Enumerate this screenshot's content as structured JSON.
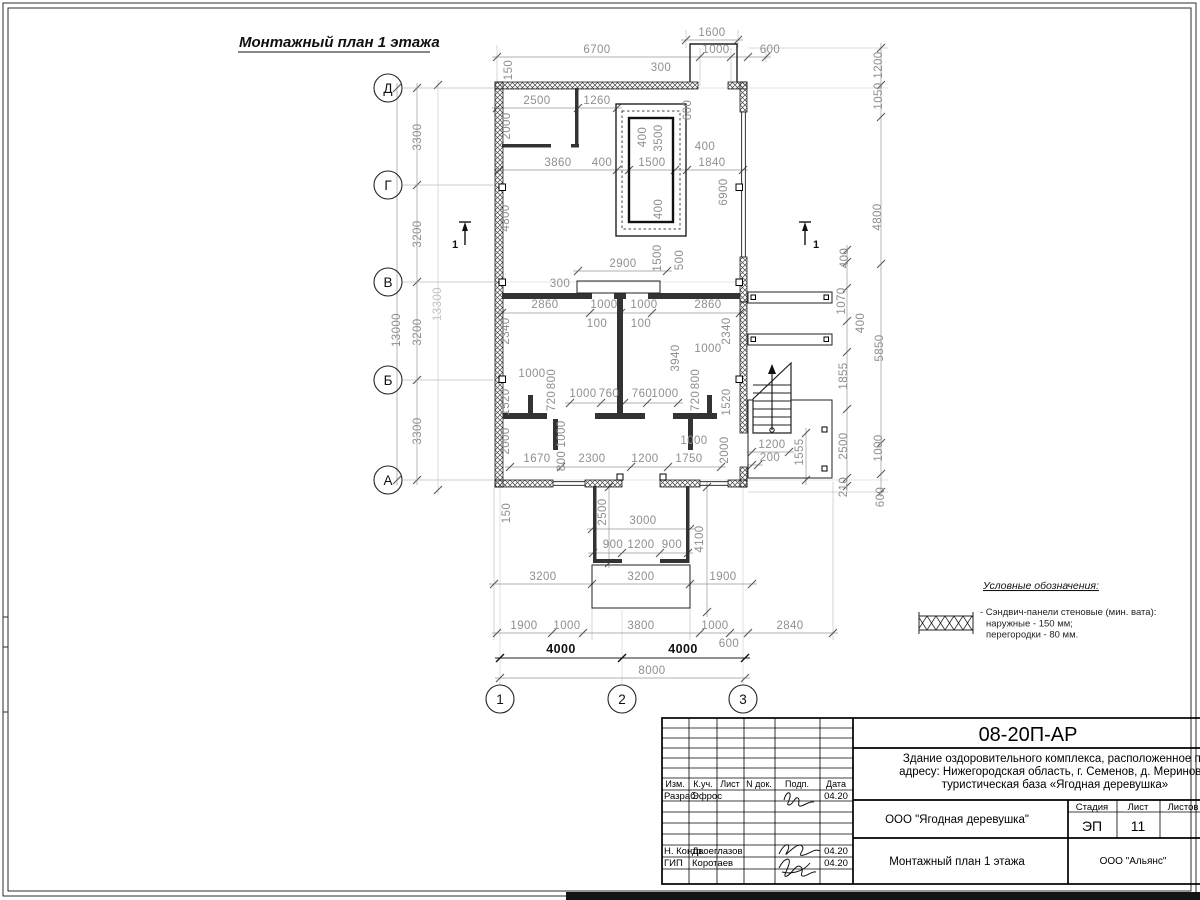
{
  "drawing_title": "Монтажный план 1 этажа",
  "plan": {
    "axes": {
      "rows": [
        "Д",
        "Г",
        "В",
        "Б",
        "А"
      ],
      "cols": [
        "1",
        "2",
        "3"
      ]
    },
    "section_label": "1",
    "dimensions": [
      {
        "t": "1600",
        "x": 712,
        "y": 36
      },
      {
        "t": "6700",
        "x": 597,
        "y": 53
      },
      {
        "t": "1000",
        "x": 716,
        "y": 53
      },
      {
        "t": "600",
        "x": 770,
        "y": 53
      },
      {
        "t": "300",
        "x": 661,
        "y": 71
      },
      {
        "t": "2500",
        "x": 537,
        "y": 104
      },
      {
        "t": "1260",
        "x": 597,
        "y": 104
      },
      {
        "t": "150",
        "x": 512,
        "y": 70,
        "r": 1
      },
      {
        "t": "2000",
        "x": 510,
        "y": 126,
        "r": 1
      },
      {
        "t": "600",
        "x": 691,
        "y": 110,
        "r": 1
      },
      {
        "t": "400",
        "x": 646,
        "y": 137,
        "r": 1
      },
      {
        "t": "3500",
        "x": 662,
        "y": 138,
        "r": 1
      },
      {
        "t": "400",
        "x": 705,
        "y": 150
      },
      {
        "t": "3860",
        "x": 558,
        "y": 166
      },
      {
        "t": "400",
        "x": 602,
        "y": 166
      },
      {
        "t": "1500",
        "x": 652,
        "y": 166
      },
      {
        "t": "1840",
        "x": 712,
        "y": 166
      },
      {
        "t": "6900",
        "x": 727,
        "y": 192,
        "r": 1
      },
      {
        "t": "4800",
        "x": 509,
        "y": 218,
        "r": 1
      },
      {
        "t": "400",
        "x": 662,
        "y": 209,
        "r": 1
      },
      {
        "t": "2900",
        "x": 623,
        "y": 267
      },
      {
        "t": "1500",
        "x": 661,
        "y": 258,
        "r": 1
      },
      {
        "t": "500",
        "x": 683,
        "y": 260,
        "r": 1
      },
      {
        "t": "300",
        "x": 560,
        "y": 287
      },
      {
        "t": "2860",
        "x": 545,
        "y": 308
      },
      {
        "t": "1000",
        "x": 604,
        "y": 308
      },
      {
        "t": "1000",
        "x": 644,
        "y": 308
      },
      {
        "t": "2860",
        "x": 708,
        "y": 308
      },
      {
        "t": "100",
        "x": 597,
        "y": 327
      },
      {
        "t": "100",
        "x": 641,
        "y": 327
      },
      {
        "t": "2340",
        "x": 509,
        "y": 331,
        "r": 1
      },
      {
        "t": "2340",
        "x": 730,
        "y": 331,
        "r": 1
      },
      {
        "t": "3940",
        "x": 679,
        "y": 358,
        "r": 1
      },
      {
        "t": "1000",
        "x": 708,
        "y": 352
      },
      {
        "t": "1000",
        "x": 532,
        "y": 377
      },
      {
        "t": "800",
        "x": 555,
        "y": 379,
        "r": 1
      },
      {
        "t": "720",
        "x": 555,
        "y": 401,
        "r": 1
      },
      {
        "t": "800",
        "x": 699,
        "y": 379,
        "r": 1
      },
      {
        "t": "720",
        "x": 699,
        "y": 401,
        "r": 1
      },
      {
        "t": "1520",
        "x": 509,
        "y": 402,
        "r": 1
      },
      {
        "t": "1520",
        "x": 730,
        "y": 402,
        "r": 1
      },
      {
        "t": "1000",
        "x": 583,
        "y": 397
      },
      {
        "t": "760",
        "x": 609,
        "y": 397
      },
      {
        "t": "760",
        "x": 642,
        "y": 397
      },
      {
        "t": "1000",
        "x": 665,
        "y": 397
      },
      {
        "t": "2000",
        "x": 509,
        "y": 441,
        "r": 1
      },
      {
        "t": "1000",
        "x": 565,
        "y": 434,
        "r": 1
      },
      {
        "t": "800",
        "x": 565,
        "y": 461,
        "r": 1
      },
      {
        "t": "1670",
        "x": 537,
        "y": 462
      },
      {
        "t": "2300",
        "x": 592,
        "y": 462
      },
      {
        "t": "1200",
        "x": 645,
        "y": 462
      },
      {
        "t": "1750",
        "x": 689,
        "y": 462
      },
      {
        "t": "1000",
        "x": 694,
        "y": 444
      },
      {
        "t": "2000",
        "x": 728,
        "y": 450,
        "r": 1
      },
      {
        "t": "1200",
        "x": 772,
        "y": 448
      },
      {
        "t": "200",
        "x": 770,
        "y": 461
      },
      {
        "t": "1555",
        "x": 803,
        "y": 452,
        "r": 1
      },
      {
        "t": "1200",
        "x": 882,
        "y": 65,
        "r": 1
      },
      {
        "t": "1050",
        "x": 882,
        "y": 96,
        "r": 1
      },
      {
        "t": "4800",
        "x": 881,
        "y": 217,
        "r": 1
      },
      {
        "t": "400",
        "x": 848,
        "y": 258,
        "r": 1
      },
      {
        "t": "1070",
        "x": 845,
        "y": 301,
        "r": 1
      },
      {
        "t": "400",
        "x": 864,
        "y": 323,
        "r": 1
      },
      {
        "t": "5850",
        "x": 883,
        "y": 348,
        "r": 1
      },
      {
        "t": "1855",
        "x": 847,
        "y": 376,
        "r": 1
      },
      {
        "t": "2500",
        "x": 847,
        "y": 446,
        "r": 1
      },
      {
        "t": "1000",
        "x": 882,
        "y": 448,
        "r": 1
      },
      {
        "t": "210",
        "x": 847,
        "y": 487,
        "r": 1
      },
      {
        "t": "600",
        "x": 884,
        "y": 497,
        "r": 1
      },
      {
        "t": "150",
        "x": 510,
        "y": 513,
        "r": 1
      },
      {
        "t": "2500",
        "x": 606,
        "y": 512,
        "r": 1
      },
      {
        "t": "3000",
        "x": 643,
        "y": 524
      },
      {
        "t": "900",
        "x": 613,
        "y": 548
      },
      {
        "t": "1200",
        "x": 641,
        "y": 548
      },
      {
        "t": "900",
        "x": 672,
        "y": 548
      },
      {
        "t": "4100",
        "x": 703,
        "y": 539,
        "r": 1
      },
      {
        "t": "3200",
        "x": 543,
        "y": 580
      },
      {
        "t": "3200",
        "x": 641,
        "y": 580
      },
      {
        "t": "1900",
        "x": 723,
        "y": 580
      },
      {
        "t": "1900",
        "x": 524,
        "y": 629
      },
      {
        "t": "1000",
        "x": 567,
        "y": 629
      },
      {
        "t": "3800",
        "x": 641,
        "y": 629
      },
      {
        "t": "1000",
        "x": 715,
        "y": 629
      },
      {
        "t": "600",
        "x": 729,
        "y": 647
      },
      {
        "t": "2840",
        "x": 790,
        "y": 629
      },
      {
        "t": "4000",
        "x": 561,
        "y": 653,
        "c": "dark"
      },
      {
        "t": "4000",
        "x": 683,
        "y": 653,
        "c": "dark"
      },
      {
        "t": "8000",
        "x": 652,
        "y": 674
      },
      {
        "t": "3300",
        "x": 421,
        "y": 137,
        "r": 1
      },
      {
        "t": "3200",
        "x": 421,
        "y": 234,
        "r": 1
      },
      {
        "t": "3200",
        "x": 421,
        "y": 332,
        "r": 1
      },
      {
        "t": "3300",
        "x": 421,
        "y": 431,
        "r": 1
      },
      {
        "t": "13000",
        "x": 400,
        "y": 330,
        "r": 1
      },
      {
        "t": "13300",
        "x": 441,
        "y": 304,
        "r": 1,
        "c": "light"
      }
    ]
  },
  "legend": {
    "heading": "Условные обозначения:",
    "item_line1": "- Сэндвич-панели стеновые (мин. вата):",
    "item_line2": "наружные - 150 мм;",
    "item_line3": "перегородки - 80 мм."
  },
  "title_block": {
    "code": "08-20П-АР",
    "description_line1": "Здание оздоровительного комплекса, расположенное по",
    "description_line2": "адресу: Нижегородская область, г. Семенов, д. Мериново,",
    "description_line3": "туристическая база «Ягодная деревушка»",
    "columns": {
      "izm": "Изм.",
      "kuch": "К.уч.",
      "list": "Лист",
      "ndok": "N док.",
      "podp": "Подп.",
      "data": "Дата"
    },
    "rows": [
      {
        "role": "Разраб.",
        "name": "Эфрос",
        "date": "04.20"
      },
      {
        "role": "Н. Контр.",
        "name": "Двоеглазов",
        "date": "04.20"
      },
      {
        "role": "ГИП",
        "name": "Коротаев",
        "date": "04.20"
      }
    ],
    "org": "ООО \"Ягодная деревушка\"",
    "doc_name": "Монтажный план 1 этажа",
    "stage_label": "Стадия",
    "sheet_label": "Лист",
    "sheets_label": "Листов",
    "stage": "ЭП",
    "sheet": "11",
    "company": "ООО \"Альянс\""
  }
}
